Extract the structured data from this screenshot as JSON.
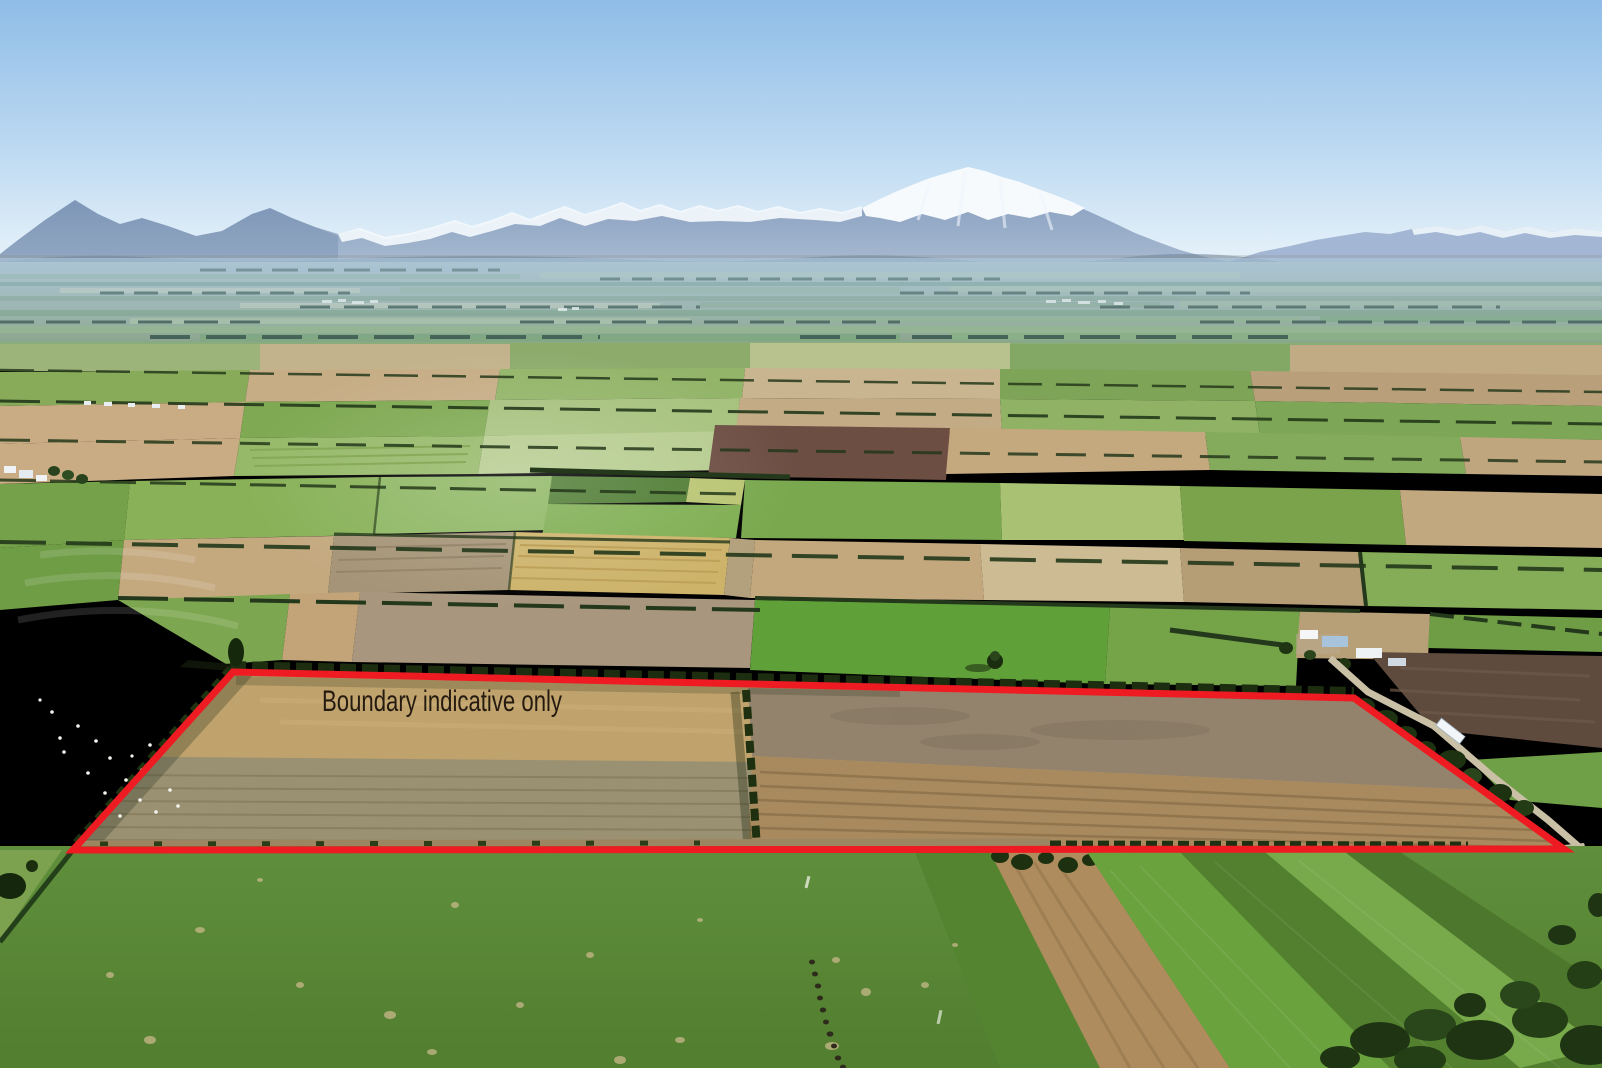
{
  "annotation": {
    "label": "Boundary indicative only",
    "label_color": "#241a10",
    "boundary_color": "#ee1b22",
    "boundary_stroke_width": "7",
    "polygon_points": "233,672 1354,698 1564,849 73,850"
  },
  "scene": {
    "description": "Aerial photograph of flat patchwork farmland on the Canterbury Plains with shelterbelts, farm buildings, a road with a white truck, grazing sheep and cattle, snow-capped mountain ranges on the horizon under a clear blue sky; a red polygon outlines the property for sale",
    "sky_color_top": "#8fbde7",
    "sky_color_horizon": "#e9f3fa",
    "mountain_color": "#8299bc",
    "snow_color": "#f5fafd",
    "pasture_green": "#5d8d3a",
    "stubble_gold": "#c2a36d",
    "bare_soil_tan": "#9a9173",
    "shelterbelt_green": "#1f3110"
  }
}
